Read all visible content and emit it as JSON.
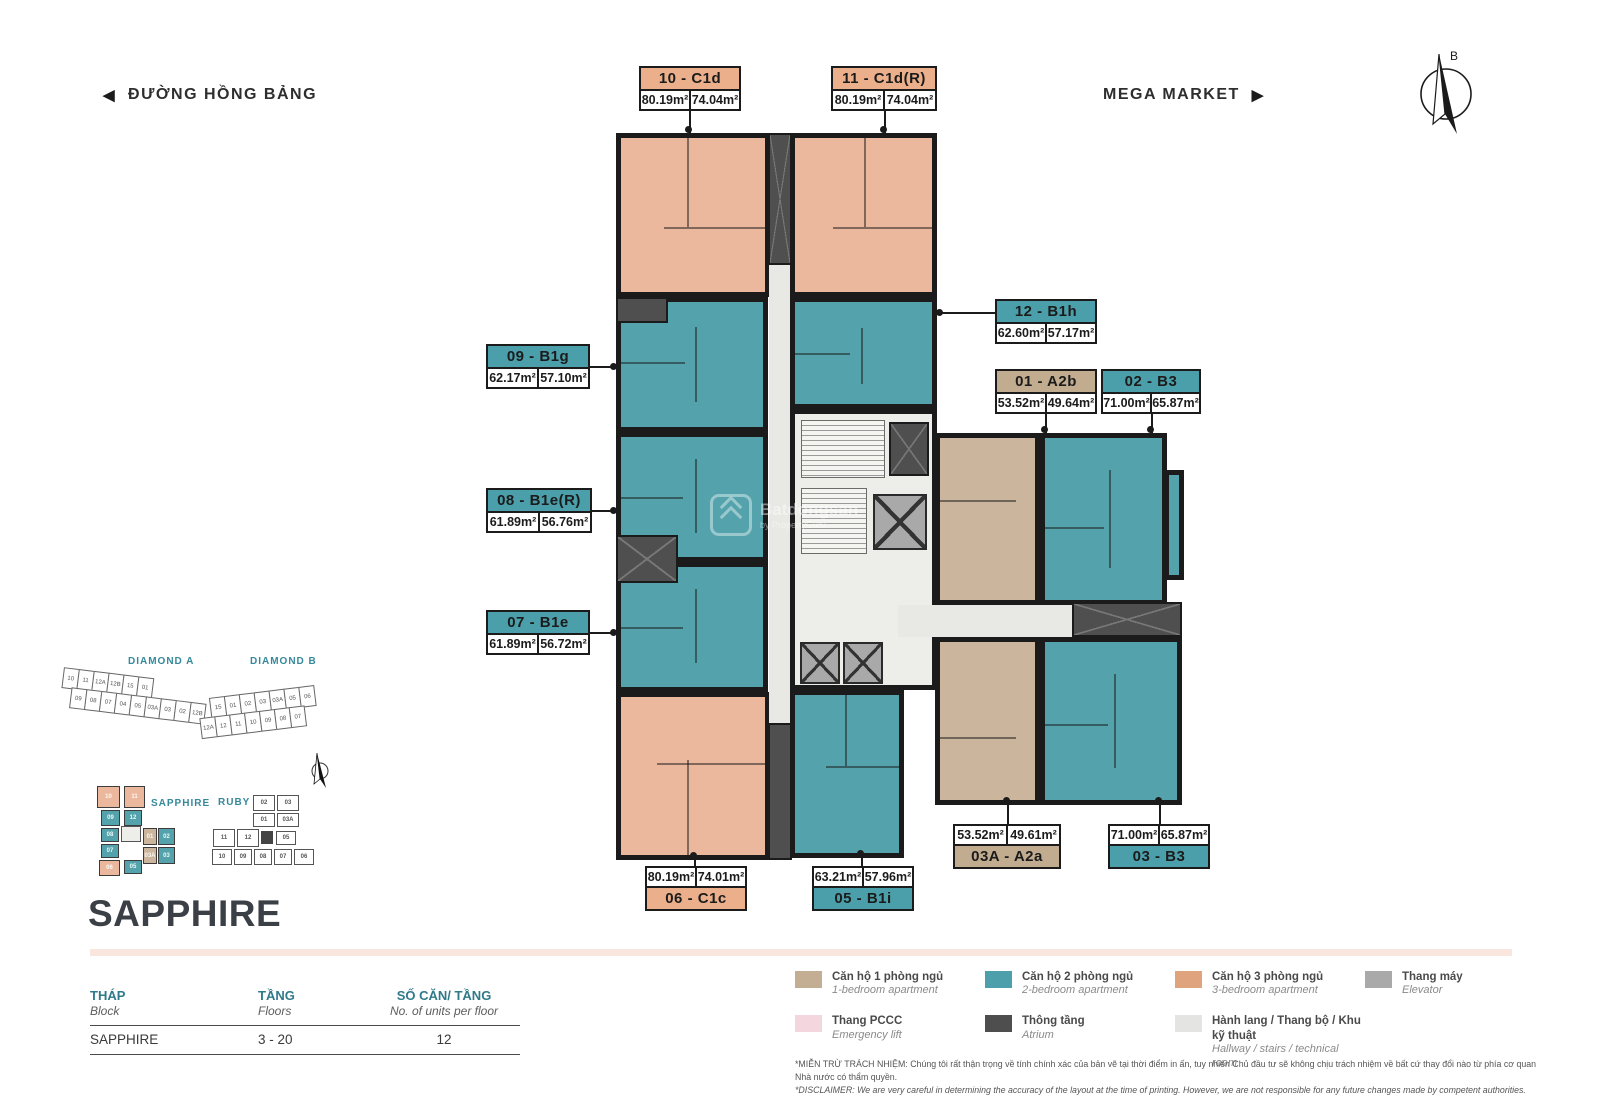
{
  "header": {
    "street_left": "ĐƯỜNG HỒNG BẢNG",
    "street_right": "MEGA MARKET",
    "compass_label": "B"
  },
  "watermark": {
    "brand": "Batdongsan",
    "sub": "by PropertyGuru"
  },
  "colors": {
    "apartment_1br": "#CBB59C",
    "apartment_2br": "#54A3AC",
    "apartment_3br": "#ECB89D",
    "walls": "#1B1B1B",
    "corridor": "#E8E8E4",
    "shaft": "#4F4F4F",
    "accent_teal": "#2F7A8A",
    "divider_pink": "#F8E6DF"
  },
  "plan": {
    "units": [
      {
        "id": "10 - C1d",
        "area1": "80.19m²",
        "area2": "74.04m²",
        "type": "3br"
      },
      {
        "id": "11 - C1d(R)",
        "area1": "80.19m²",
        "area2": "74.04m²",
        "type": "3br"
      },
      {
        "id": "12 - B1h",
        "area1": "62.60m²",
        "area2": "57.17m²",
        "type": "2br"
      },
      {
        "id": "09 - B1g",
        "area1": "62.17m²",
        "area2": "57.10m²",
        "type": "2br"
      },
      {
        "id": "01 - A2b",
        "area1": "53.52m²",
        "area2": "49.64m²",
        "type": "1br"
      },
      {
        "id": "02 - B3",
        "area1": "71.00m²",
        "area2": "65.87m²",
        "type": "2br"
      },
      {
        "id": "08 - B1e(R)",
        "area1": "61.89m²",
        "area2": "56.76m²",
        "type": "2br"
      },
      {
        "id": "07 - B1e",
        "area1": "61.89m²",
        "area2": "56.72m²",
        "type": "2br"
      },
      {
        "id": "06 - C1c",
        "area1": "80.19m²",
        "area2": "74.01m²",
        "type": "3br"
      },
      {
        "id": "05 - B1i",
        "area1": "63.21m²",
        "area2": "57.96m²",
        "type": "2br"
      },
      {
        "id": "03A - A2a",
        "area1": "53.52m²",
        "area2": "49.61m²",
        "type": "1br"
      },
      {
        "id": "03 - B3",
        "area1": "71.00m²",
        "area2": "65.87m²",
        "type": "2br"
      }
    ]
  },
  "minimap": {
    "diamond_a": {
      "title": "DIAMOND A",
      "row1": [
        "10",
        "11",
        "12A",
        "12B",
        "15",
        "01"
      ],
      "row2": [
        "09",
        "08",
        "07",
        "04",
        "05",
        "03A",
        "03",
        "02",
        "12B"
      ]
    },
    "diamond_b": {
      "title": "DIAMOND B",
      "row1": [
        "15",
        "01",
        "02",
        "03",
        "03A",
        "05",
        "06"
      ],
      "row2": [
        "12A",
        "12",
        "11",
        "10",
        "09",
        "08",
        "07"
      ]
    },
    "sapphire": {
      "title": "SAPPHIRE",
      "units": [
        {
          "label": "10",
          "type": "3br"
        },
        {
          "label": "11",
          "type": "3br"
        },
        {
          "label": "09",
          "type": "2br"
        },
        {
          "label": "12",
          "type": "2br"
        },
        {
          "label": "08",
          "type": "2br"
        },
        {
          "label": "01",
          "type": "1br"
        },
        {
          "label": "02",
          "type": "2br"
        },
        {
          "label": "07",
          "type": "2br"
        },
        {
          "label": "03A",
          "type": "1br"
        },
        {
          "label": "03",
          "type": "2br"
        },
        {
          "label": "06",
          "type": "3br"
        },
        {
          "label": "05",
          "type": "2br"
        }
      ]
    },
    "ruby": {
      "title": "RUBY",
      "units": [
        "02",
        "03",
        "01",
        "03A",
        "11",
        "12",
        "05",
        "10",
        "09",
        "08",
        "07",
        "06"
      ]
    }
  },
  "info": {
    "title": "SAPPHIRE",
    "table": {
      "headers": [
        {
          "vn": "THÁP",
          "en": "Block"
        },
        {
          "vn": "TẦNG",
          "en": "Floors"
        },
        {
          "vn": "SỐ CĂN/ TẦNG",
          "en": "No. of units per floor"
        }
      ],
      "row": {
        "block": "SAPPHIRE",
        "floors": "3 - 20",
        "units_per_floor": "12"
      }
    }
  },
  "legend": {
    "items": [
      {
        "vn": "Căn hộ 1 phòng ngủ",
        "en": "1-bedroom apartment",
        "color": "#C3AD93"
      },
      {
        "vn": "Căn hộ 2 phòng ngủ",
        "en": "2-bedroom apartment",
        "color": "#4DA0AB"
      },
      {
        "vn": "Căn hộ 3 phòng ngủ",
        "en": "3-bedroom apartment",
        "color": "#DFA47E"
      },
      {
        "vn": "Thang  máy",
        "en": "Elevator",
        "color": "#A9A9A9"
      },
      {
        "vn": "Thang  PCCC",
        "en": "Emergency lift",
        "color": "#F3D6DE"
      },
      {
        "vn": "Thông tầng",
        "en": "Atrium",
        "color": "#4E4E4E"
      },
      {
        "vn": "Hành lang / Thang bộ / Khu kỹ thuật",
        "en": "Hallway / stairs / technical room",
        "color": "#E4E4E2"
      }
    ]
  },
  "disclaimer": {
    "vn": "*MIỄN TRỪ TRÁCH NHIỆM: Chúng tôi rất thận trọng về tính chính xác của bản vẽ tại thời điểm in ấn, tuy nhiên Chủ đầu tư sẽ không chịu trách nhiệm về bất cứ thay đổi nào từ phía cơ quan Nhà nước có thẩm quyền.",
    "en": "*DISCLAIMER: We are very careful in determining the accuracy of the layout at the time of printing. However, we are not responsible for any future changes made by competent authorities."
  }
}
